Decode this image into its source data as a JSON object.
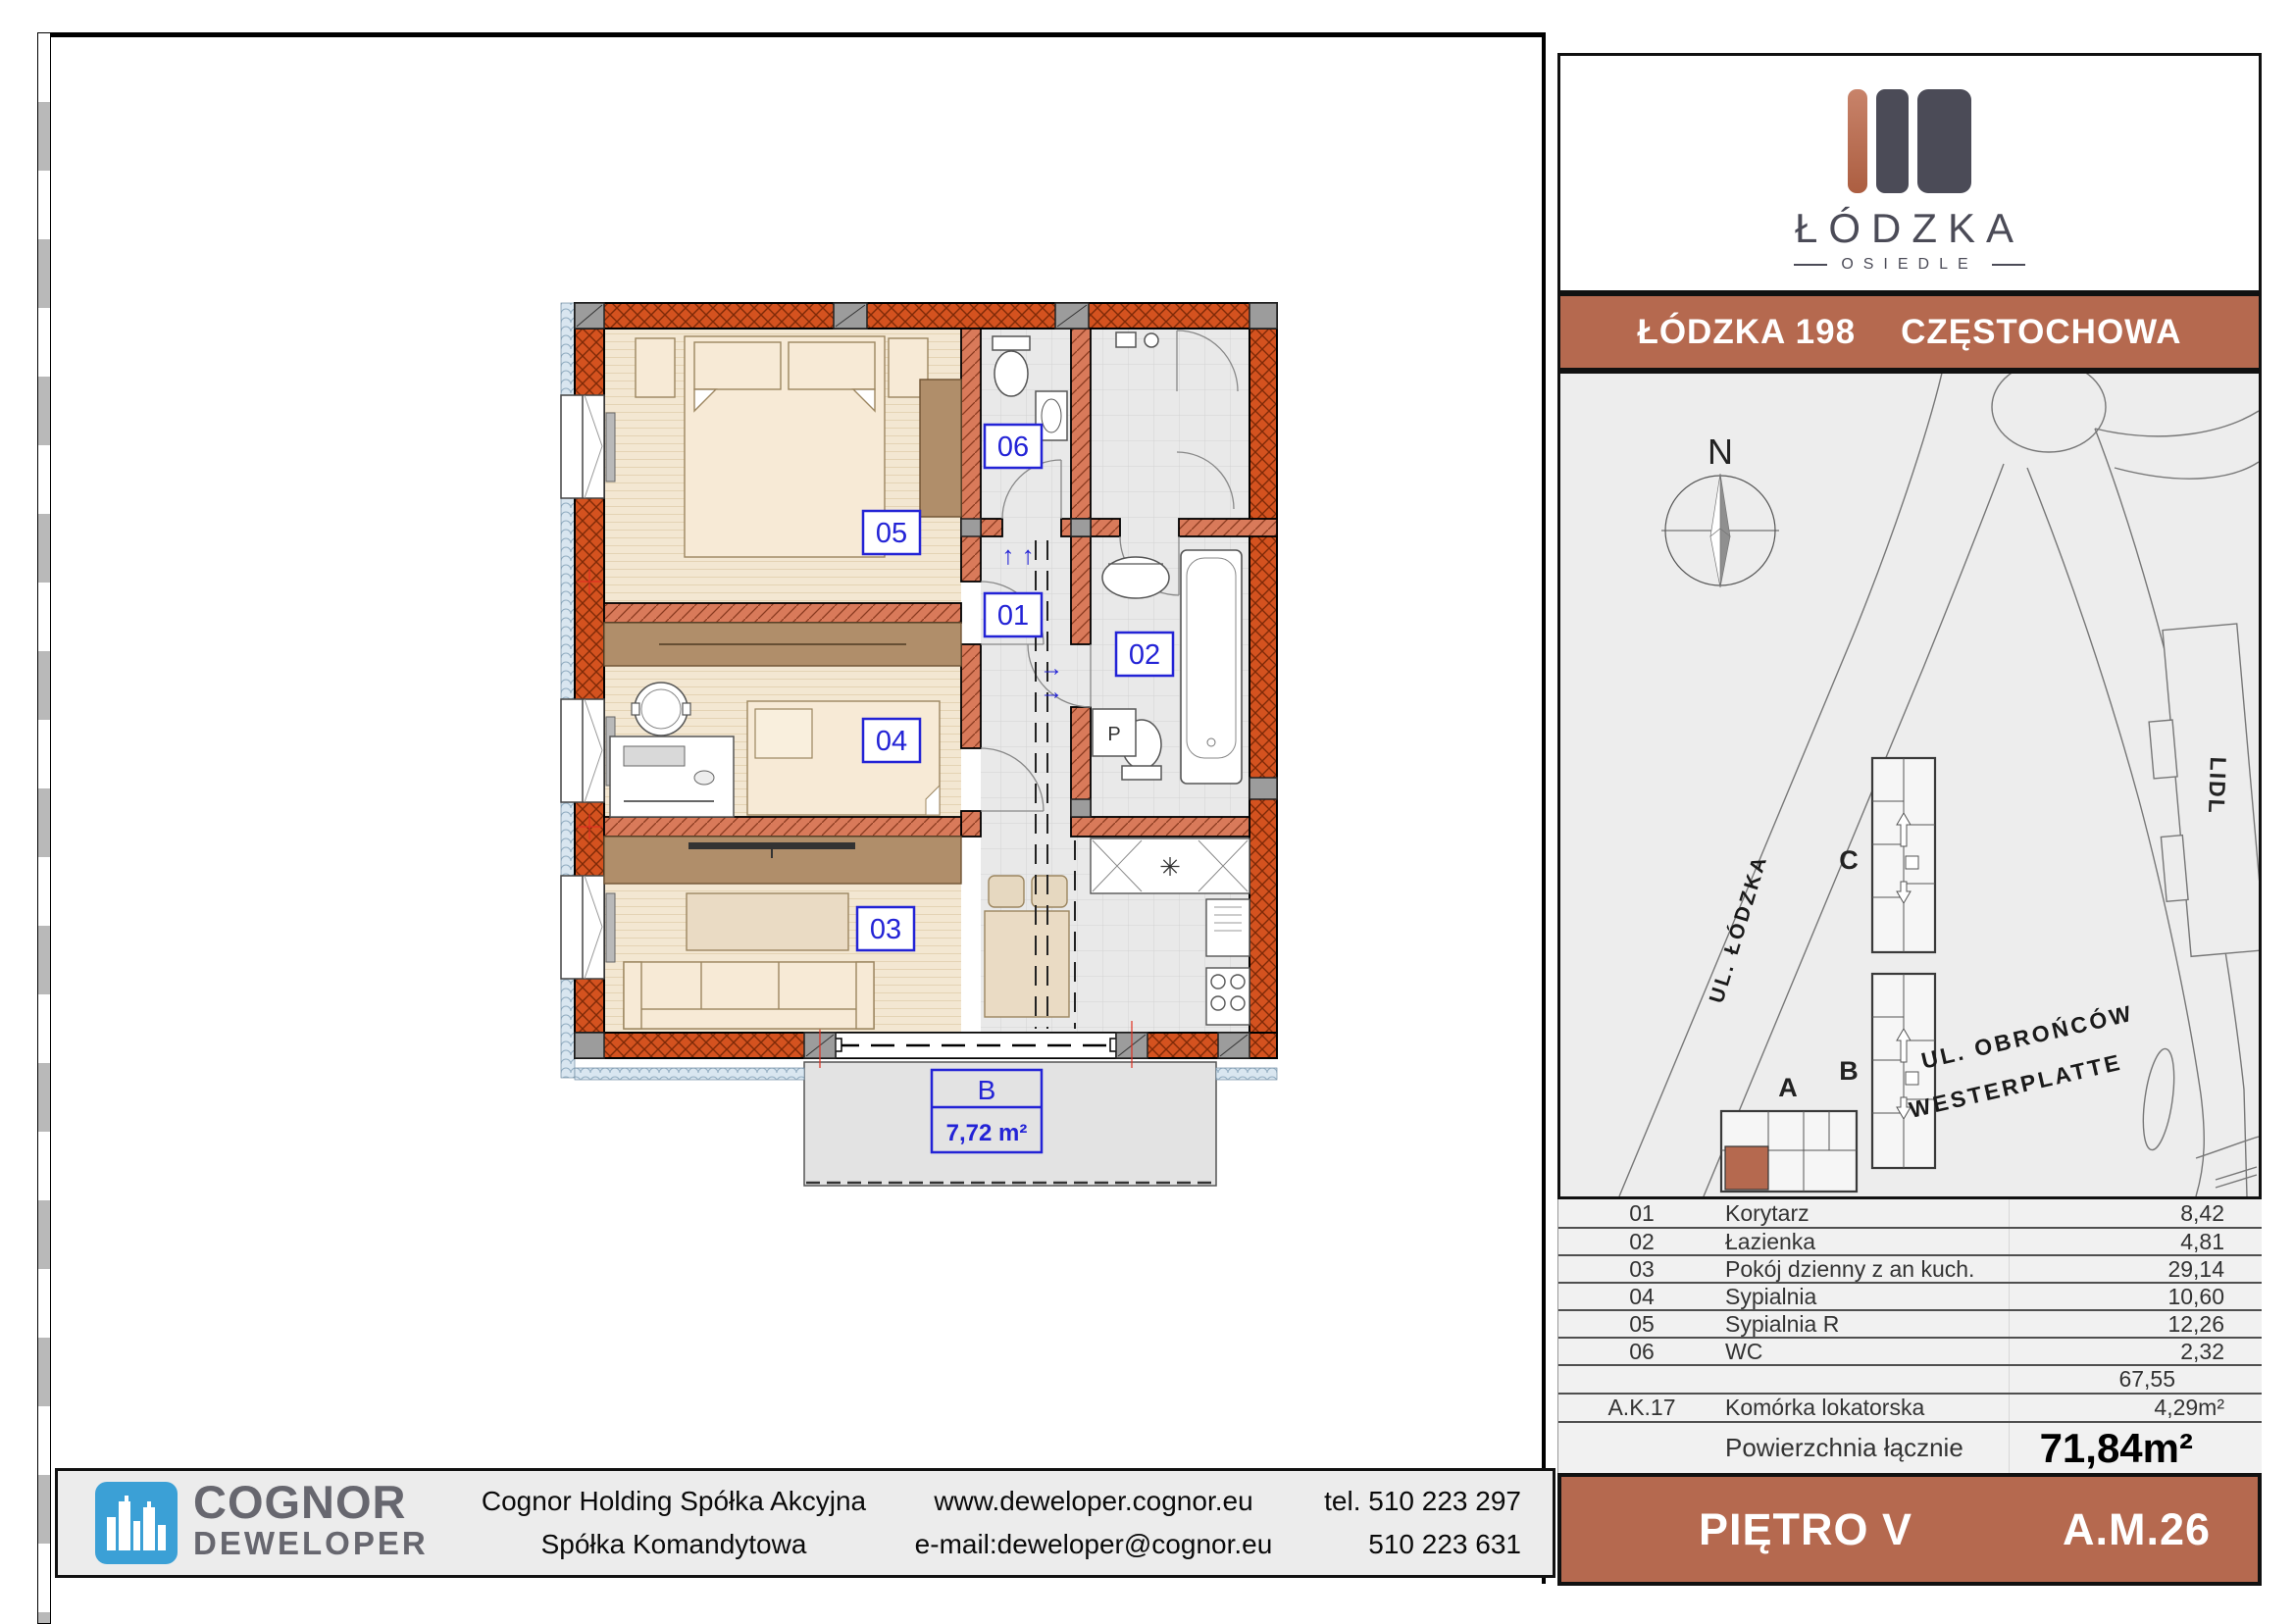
{
  "plan": {
    "rooms": {
      "r01": "01",
      "r02": "02",
      "r03": "03",
      "r04": "04",
      "r05": "05",
      "r06": "06"
    },
    "balcony_label": "B",
    "balcony_area": "7,72 m²",
    "washer_label": "P",
    "stairs_arrows": "↑ ↑",
    "door_arrow": "→",
    "sink_glyph": "✳"
  },
  "brand_panel": {
    "logo_text": "ŁÓDZKA",
    "logo_subtext": "OSIEDLE",
    "header_left": "ŁÓDZKA 198",
    "header_right": "CZĘSTOCHOWA"
  },
  "site_map": {
    "compass": "N",
    "building_a": "A",
    "building_b": "B",
    "building_c": "C",
    "store": "LIDL",
    "street_lodzka": "UL. ŁÓDZKA",
    "street_obroncow_1": "UL. OBROŃCÓW",
    "street_obroncow_2": "WESTERPLATTE"
  },
  "area_table": {
    "rows": [
      {
        "no": "01",
        "name": "Korytarz",
        "area": "8,42"
      },
      {
        "no": "02",
        "name": "Łazienka",
        "area": "4,81"
      },
      {
        "no": "03",
        "name": "Pokój dzienny z an kuch.",
        "area": "29,14"
      },
      {
        "no": "04",
        "name": "Sypialnia",
        "area": "10,60"
      },
      {
        "no": "05",
        "name": "Sypialnia R",
        "area": "12,26"
      },
      {
        "no": "06",
        "name": "WC",
        "area": "2,32"
      },
      {
        "no": "",
        "name": "",
        "area": "67,55"
      },
      {
        "no": "A.K.17",
        "name": "Komórka lokatorska",
        "area": "4,29m²"
      },
      {
        "no": "",
        "name": "Powierzchnia łącznie",
        "area": "71,84m²"
      }
    ]
  },
  "floor_bar": {
    "floor": "PIĘTRO V",
    "unit": "A.M.26"
  },
  "footer": {
    "brand_line1": "COGNOR",
    "brand_line2": "DEWELOPER",
    "company_line1": "Cognor Holding Spółka Akcyjna",
    "company_line2": "Spółka Komandytowa",
    "website": "www.deweloper.cognor.eu",
    "email": "e-mail:deweloper@cognor.eu",
    "phone1": "tel. 510 223 297",
    "phone2": "510 223 631"
  },
  "colors": {
    "accent_terracotta": "#b5694f",
    "wall_red": "#d4521f",
    "label_blue": "#2323d6",
    "logo_blue": "#3ba0d6",
    "dark_gray": "#4b4b57"
  }
}
